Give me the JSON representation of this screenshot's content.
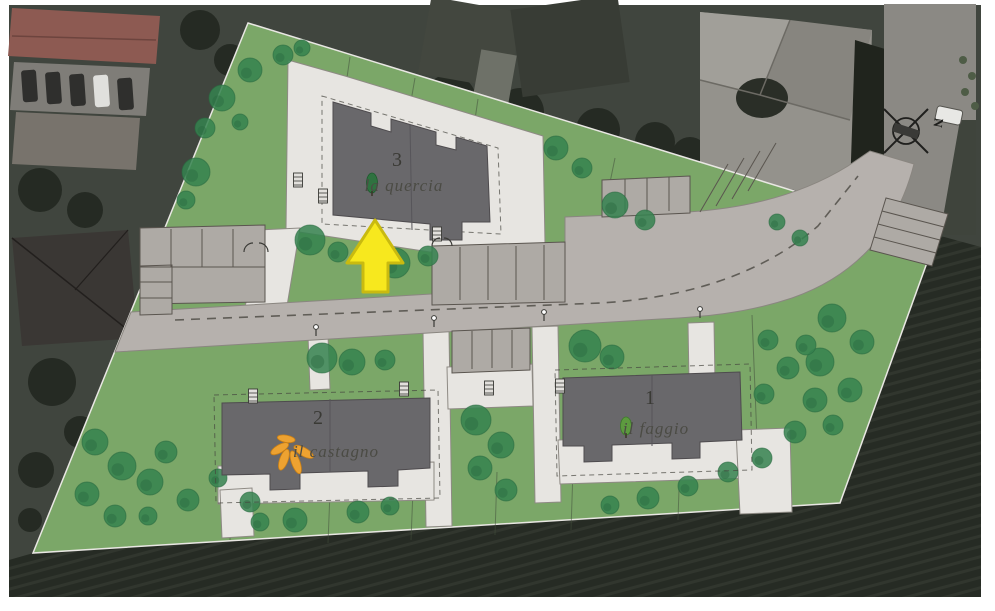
{
  "site": {
    "buildings": [
      {
        "number": "3",
        "name": "la quercia"
      },
      {
        "number": "2",
        "name": "il castagno"
      },
      {
        "number": "1",
        "name": "il faggio"
      }
    ],
    "compass": {
      "label": "N"
    },
    "colors": {
      "lawn": "#7ba768",
      "tree": "#35824f",
      "tree_dark": "#2a6b41",
      "road": "#b6b1ad",
      "paving": "#e7e5e1",
      "roof": "#69686b",
      "arrow": "#f7e81e",
      "arrow_outline": "#c9ba10",
      "field": "#262b24"
    }
  }
}
